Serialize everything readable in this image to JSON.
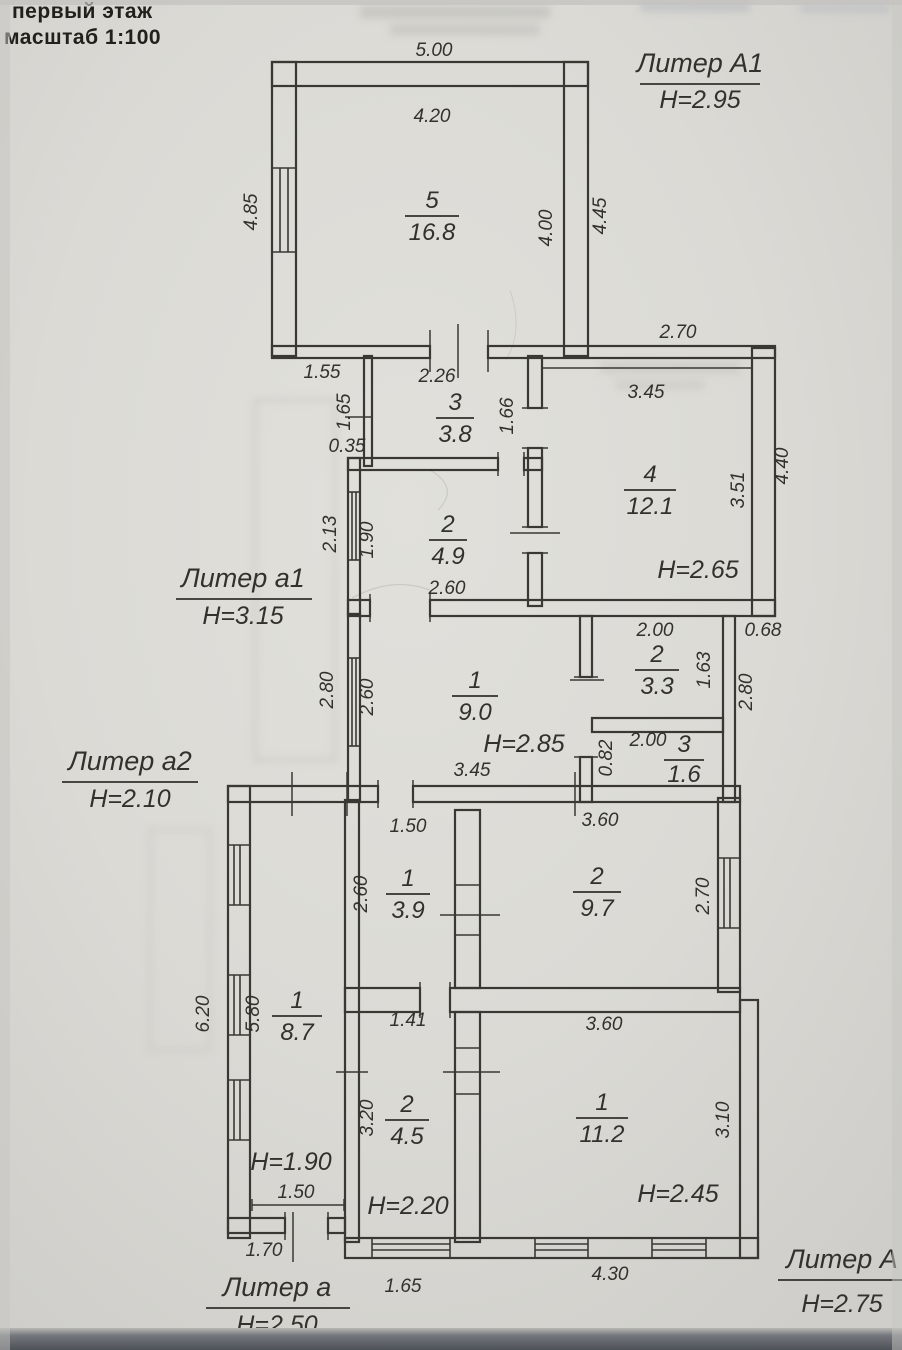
{
  "title": {
    "line1": "первый этаж",
    "line2": "масштаб 1:100"
  },
  "liters": {
    "A1": {
      "name": "Литер А1",
      "h": "Н=2.95"
    },
    "a1": {
      "name": "Литер а1",
      "h": "Н=3.15"
    },
    "a2": {
      "name": "Литер а2",
      "h": "Н=2.10"
    },
    "a": {
      "name": "Литер а",
      "h": "Н=2.50"
    },
    "A": {
      "name": "Литер А",
      "h": "Н=2.75"
    }
  },
  "rooms": {
    "r5": {
      "num": "5",
      "area": "16.8"
    },
    "r3t": {
      "num": "3",
      "area": "3.8"
    },
    "r2t": {
      "num": "2",
      "area": "4.9"
    },
    "r4": {
      "num": "4",
      "area": "12.1",
      "h": "Н=2.65"
    },
    "r1m": {
      "num": "1",
      "area": "9.0",
      "h": "Н=2.85"
    },
    "r2m": {
      "num": "2",
      "area": "3.3"
    },
    "r3m": {
      "num": "3",
      "area": "1.6"
    },
    "r1c": {
      "num": "1",
      "area": "8.7",
      "h": "Н=1.90"
    },
    "r1b": {
      "num": "1",
      "area": "3.9"
    },
    "r2b": {
      "num": "2",
      "area": "9.7"
    },
    "r2bb": {
      "num": "2",
      "area": "4.5",
      "h": "Н=2.20"
    },
    "r1bb": {
      "num": "1",
      "area": "11.2",
      "h": "Н=2.45"
    }
  },
  "dims": {
    "d500": "5.00",
    "d420": "4.20",
    "d485": "4.85",
    "d445": "4.45",
    "d400": "4.00",
    "d155": "1.55",
    "d226": "2.26",
    "d165": "1.65",
    "d035": "0.35",
    "d166": "1.66",
    "d270ne": "2.70",
    "d345r4": "3.45",
    "d351": "3.51",
    "d440": "4.40",
    "d213": "2.13",
    "d190": "1.90",
    "d260r2t": "2.60",
    "d280w": "2.80",
    "d260r1m": "2.60",
    "d345r1m": "3.45",
    "d200r2m": "2.00",
    "d163": "1.63",
    "d068": "0.68",
    "d280e": "2.80",
    "d200r3m": "2.00",
    "d082": "0.82",
    "d620": "6.20",
    "d580": "5.80",
    "d150col": "1.50",
    "d170": "1.70",
    "d150r1b": "1.50",
    "d260r1b": "2.60",
    "d360r2b": "3.60",
    "d270r2b": "2.70",
    "d141": "1.41",
    "d320": "3.20",
    "d360r1bb": "3.60",
    "d310": "3.10",
    "d165bot": "1.65",
    "d430": "4.30"
  }
}
